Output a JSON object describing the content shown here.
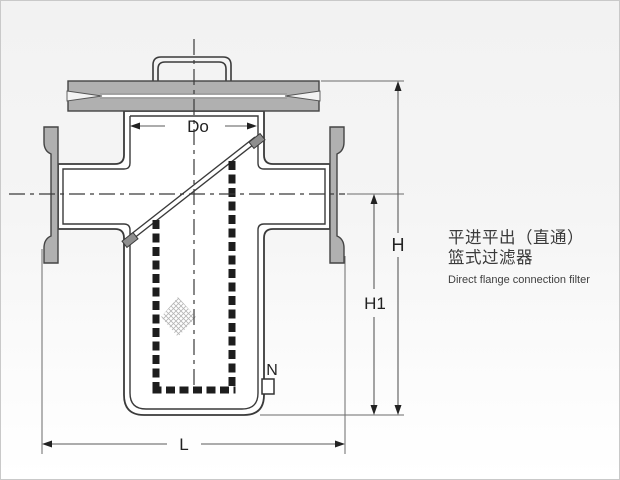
{
  "caption": {
    "title_line1": "平进平出（直通）",
    "title_line2": "篮式过滤器",
    "subtitle_en": "Direct flange connection filter"
  },
  "dimensions": {
    "basket_diameter": "Do",
    "total_height": "H",
    "center_height": "H1",
    "flange_length": "L",
    "drain_port": "N"
  },
  "colors": {
    "metal": "#b0b0b0",
    "outline": "#3a3a3a",
    "dim_line": "#5a5a5a",
    "background_top": "#f2f2f2",
    "background_bottom": "#ffffff"
  }
}
